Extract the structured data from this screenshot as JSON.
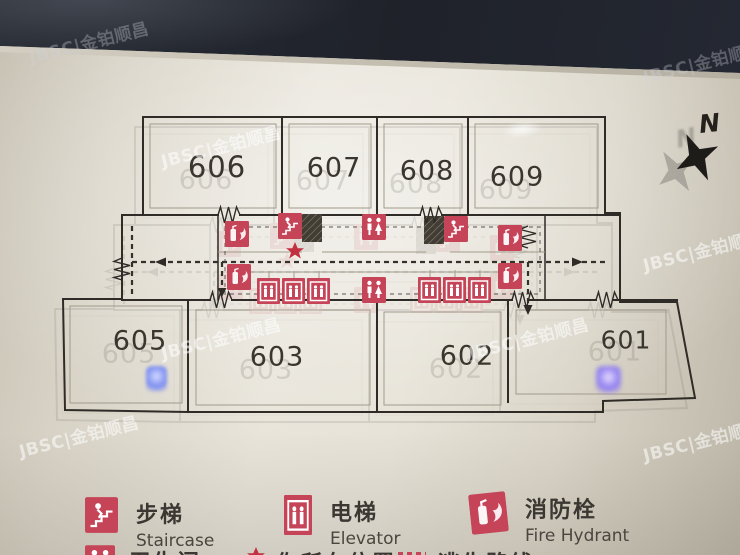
{
  "watermark": {
    "text": "JBSC|金铂顺昌"
  },
  "compass": {
    "label": "N"
  },
  "plan": {
    "rooms": [
      {
        "number": "606"
      },
      {
        "number": "607"
      },
      {
        "number": "608"
      },
      {
        "number": "609"
      },
      {
        "number": "605"
      },
      {
        "number": "603"
      },
      {
        "number": "602"
      },
      {
        "number": "601"
      }
    ],
    "icon_names": [
      "fire-hydrant",
      "staircase",
      "toilet",
      "elevator",
      "you-are-here-star",
      "escape-route"
    ]
  },
  "legend": {
    "items": [
      {
        "name": "staircase",
        "zh": "步梯",
        "en": "Staircase"
      },
      {
        "name": "elevator",
        "zh": "电梯",
        "en": "Elevator"
      },
      {
        "name": "fire-hydrant",
        "zh": "消防栓",
        "en": "Fire Hydrant"
      },
      {
        "name": "toilet",
        "zh": "卫生间"
      },
      {
        "name": "you-are-here",
        "zh": "你所在位置"
      },
      {
        "name": "escape-route",
        "zh": "逃生路线"
      }
    ]
  },
  "colors": {
    "icon_red": "#c64458",
    "star_red": "#c33040",
    "plan_line": "#2f2b27",
    "led_blue": "#7d8ef0",
    "panel_dark": "#23262e"
  }
}
